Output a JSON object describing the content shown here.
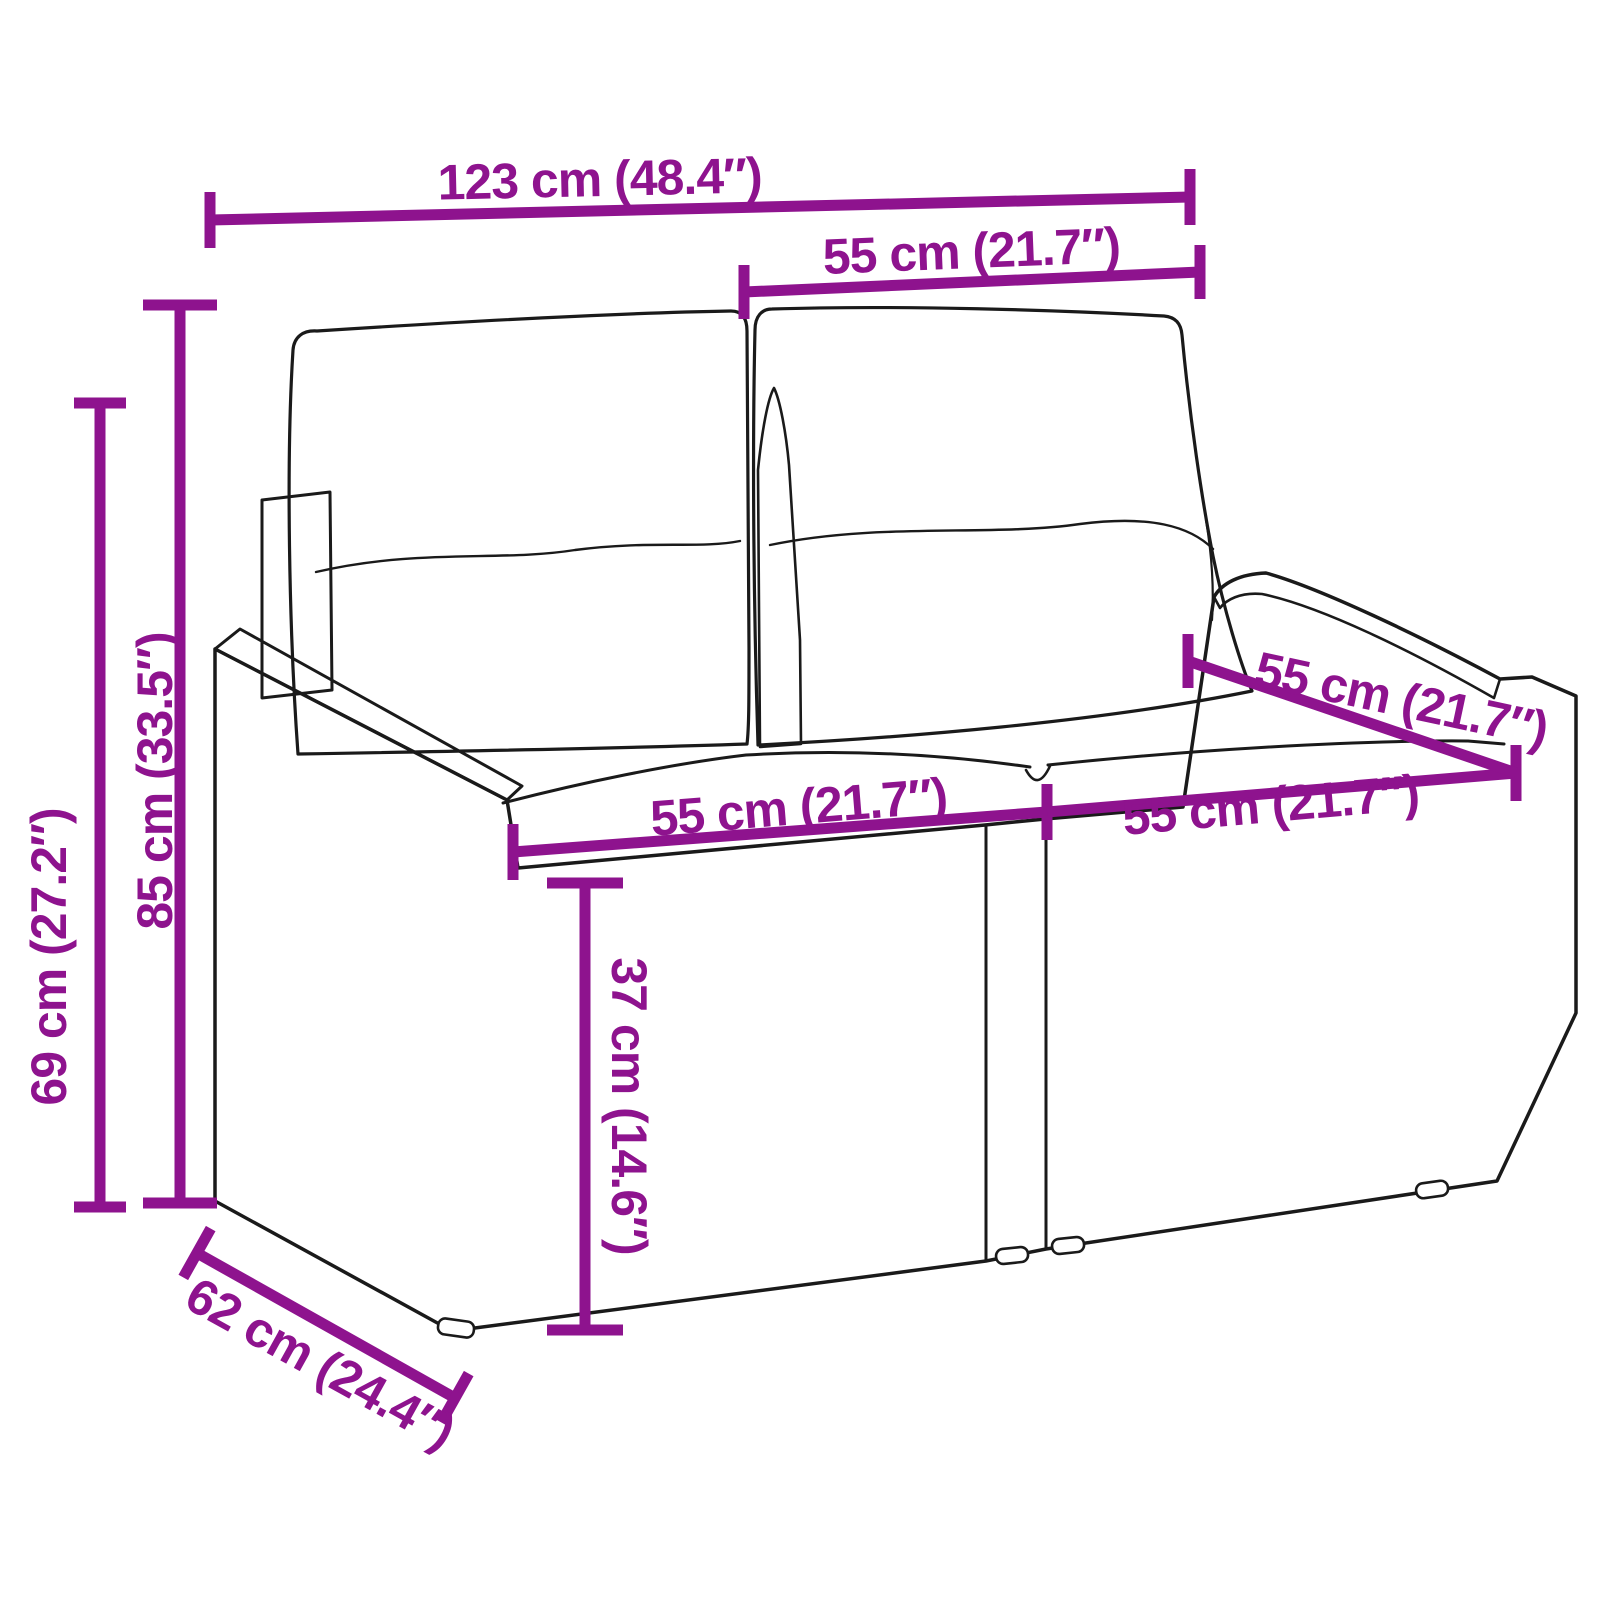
{
  "meta": {
    "type": "product-dimension-diagram",
    "product": "poly rattan 2-seater garden sofa with cushions",
    "background": "#FFFFFF",
    "accent_color": "#8E138E",
    "line_art_color": "#1A1A1A"
  },
  "dimensions": {
    "overall_width": {
      "label": "123 cm (48.4″)"
    },
    "back_cushion_width": {
      "label": "55 cm (21.7″)"
    },
    "overall_height": {
      "label": "85 cm (33.5″)"
    },
    "armrest_height": {
      "label": "69 cm (27.2″)"
    },
    "seat_width_left": {
      "label": "55 cm (21.7″)"
    },
    "seat_width_right": {
      "label": "55 cm (21.7″)"
    },
    "seat_depth": {
      "label": "55 cm (21.7″)"
    },
    "seat_height": {
      "label": "37 cm (14.6″)"
    },
    "overall_depth": {
      "label": "62 cm (24.4″)"
    }
  }
}
